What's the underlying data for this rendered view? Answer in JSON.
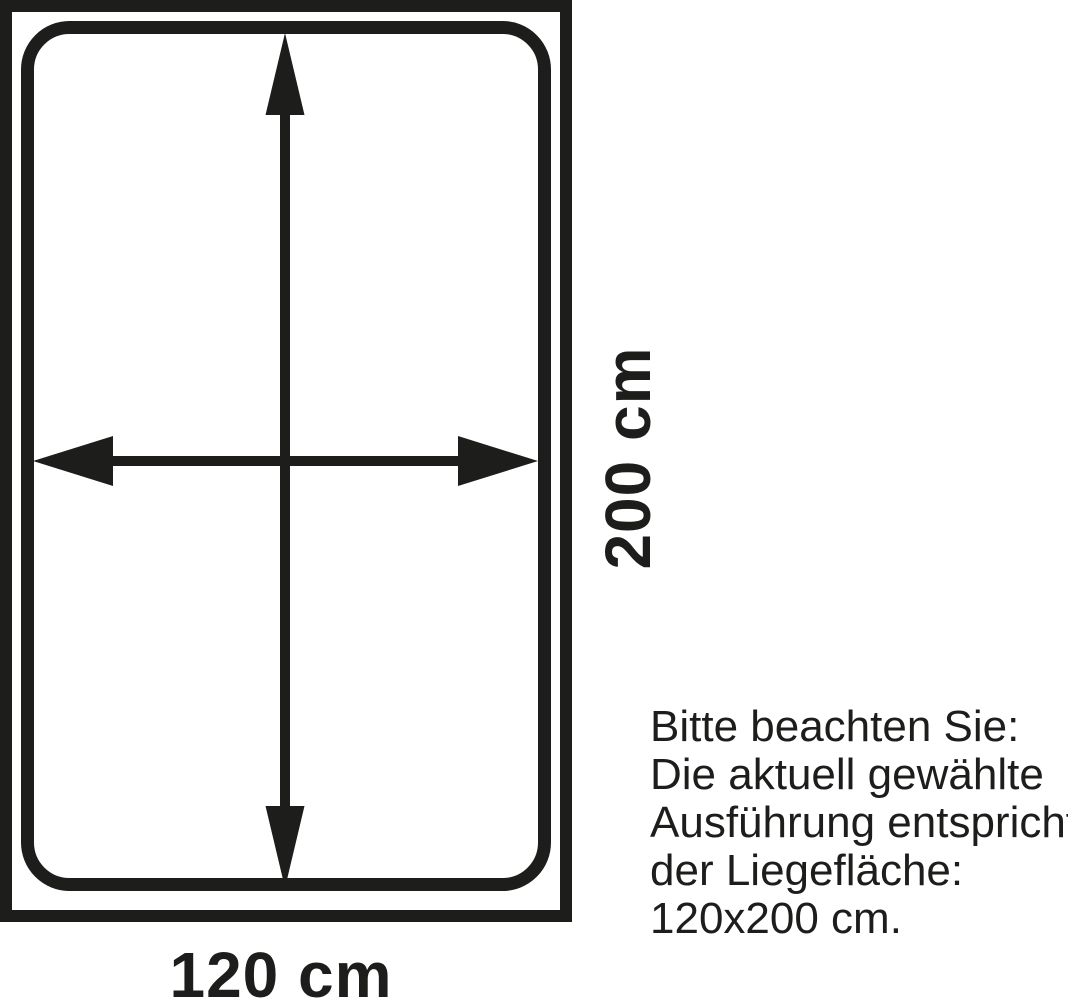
{
  "colors": {
    "ink": "#1d1d1b",
    "background": "#ffffff"
  },
  "diagram": {
    "height_label": "200 cm",
    "width_label": "120 cm"
  },
  "note": {
    "lines": [
      "Bitte beachten Sie:",
      "Die aktuell gewählte",
      "Ausführung entspricht",
      "der Liegefläche:",
      "120x200 cm."
    ]
  }
}
